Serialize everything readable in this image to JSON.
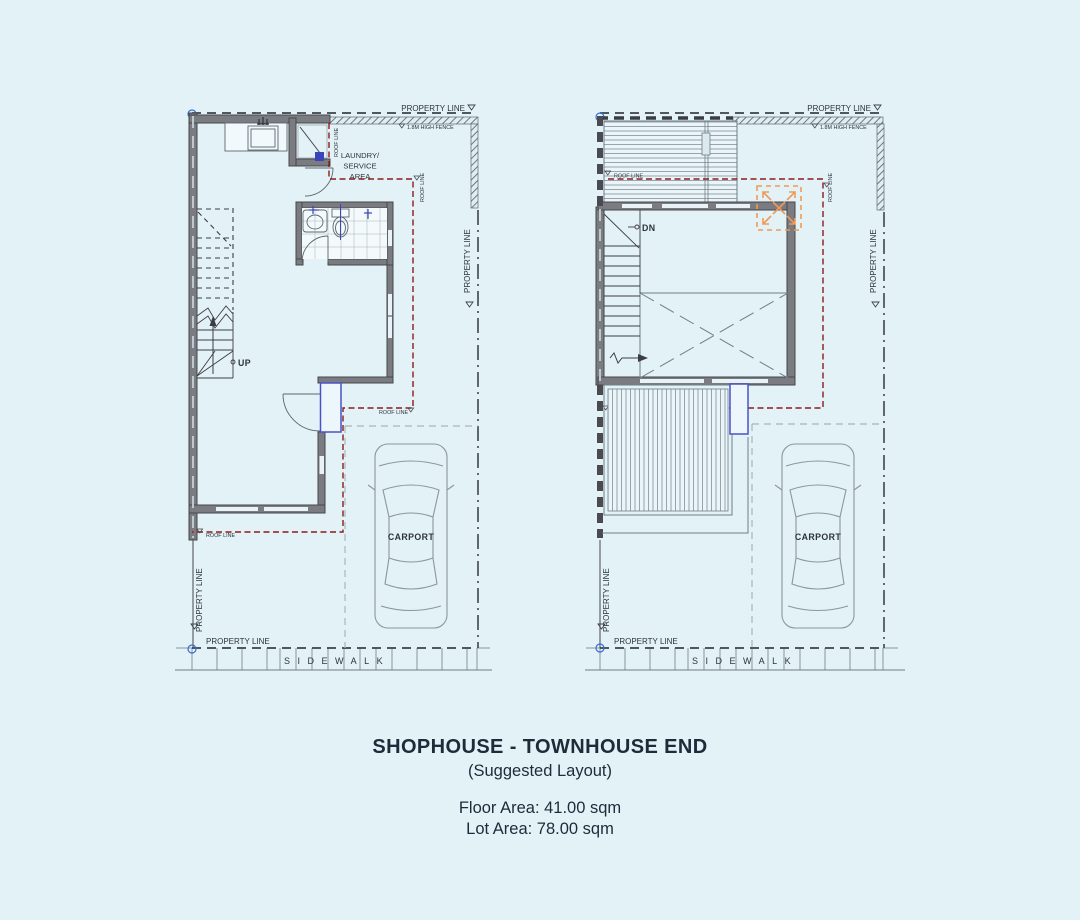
{
  "footer": {
    "title": "SHOPHOUSE - TOWNHOUSE END",
    "subtitle": "(Suggested Layout)",
    "floor_area": "Floor Area: 41.00 sqm",
    "lot_area": "Lot Area: 78.00 sqm"
  },
  "labels": {
    "property_line": "PROPERTY LINE",
    "high_fence": "1.8M HIGH FENCE",
    "roof_line": "ROOF LINE",
    "laundry_1": "LAUNDRY/",
    "laundry_2": "SERVICE",
    "laundry_3": "AREA",
    "up": "UP",
    "dn": "DN",
    "carport": "CARPORT",
    "sidewalk": "SIDEWALK"
  },
  "colors": {
    "background": "#e3f2f7",
    "wall": "#7b7c81",
    "wall_edge": "#46474c",
    "roof_line_red": "#8c1b1b",
    "window_blue": "#4953c8",
    "marker_orange": "#f09a55",
    "carport_dash": "#a9b5bb",
    "title_text": "#1d2b3a"
  }
}
